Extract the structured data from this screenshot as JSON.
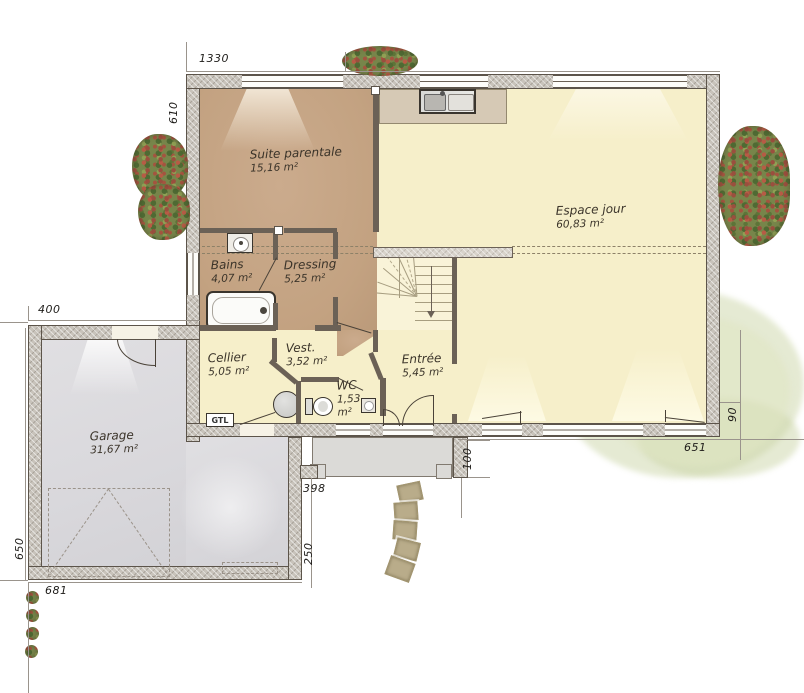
{
  "plan": {
    "title": "Floor plan – single storey house with garage",
    "rooms": [
      {
        "name": "Suite parentale",
        "area": "15,16 m²"
      },
      {
        "name": "Espace jour",
        "area": "60,83 m²"
      },
      {
        "name": "Bains",
        "area": "4,07 m²"
      },
      {
        "name": "Dressing",
        "area": "5,25 m²"
      },
      {
        "name": "Cellier",
        "area": "5,05 m²"
      },
      {
        "name": "Vest.",
        "area": "3,52 m²"
      },
      {
        "name": "WC",
        "area": "1,53 m²"
      },
      {
        "name": "Entrée",
        "area": "5,45 m²"
      },
      {
        "name": "Garage",
        "area": "31,67 m²"
      }
    ],
    "fixtures": {
      "gtl_label": "GTL"
    },
    "dimensions_cm": [
      "1330",
      "610",
      "400",
      "650",
      "681",
      "398",
      "250",
      "100",
      "651",
      "90"
    ]
  },
  "colors": {
    "room_tan": "#c3a281",
    "room_yellow": "#f6efca",
    "garage_gray": "#dcdbde",
    "wall_hatch": "#c8c3bb",
    "wall_dark": "#6b6156",
    "terrace_green": "#cbd5a8"
  }
}
